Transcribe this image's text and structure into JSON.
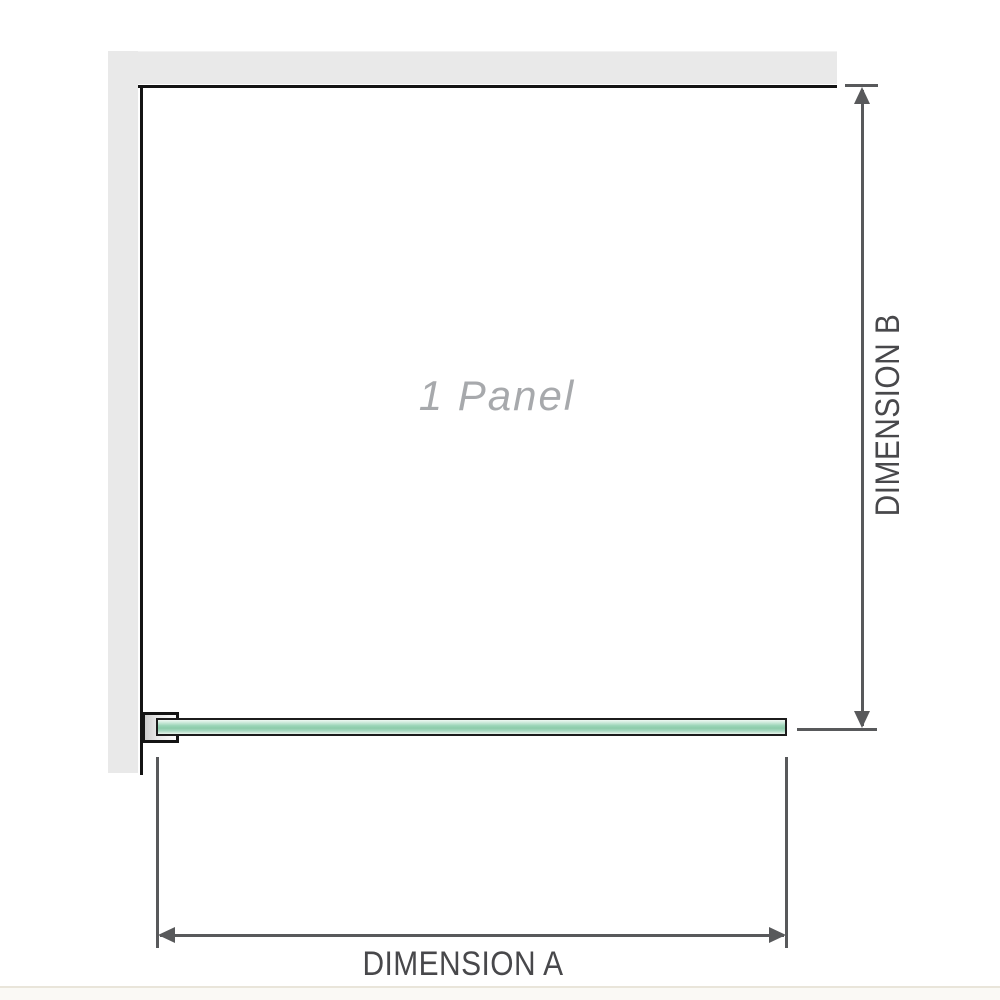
{
  "diagram": {
    "title": "shower-screen-plan-view",
    "panel_label": "1 Panel",
    "dimension_a": {
      "label": "DIMENSION A",
      "orientation": "horizontal"
    },
    "dimension_b": {
      "label": "DIMENSION B",
      "orientation": "vertical"
    }
  },
  "colors": {
    "background": "#ffffff",
    "wall_fill": "#e9e9e9",
    "wall_edge": "#141414",
    "dimension_line": "#58595b",
    "dimension_text": "#48484b",
    "panel_label_text": "#a7a9ac",
    "glass_green_mid": "#8ccbaa",
    "glass_green_light": "#e7f4ec",
    "glass_outline": "#1c1c1c",
    "bottom_edge_line": "#e9e5da"
  }
}
